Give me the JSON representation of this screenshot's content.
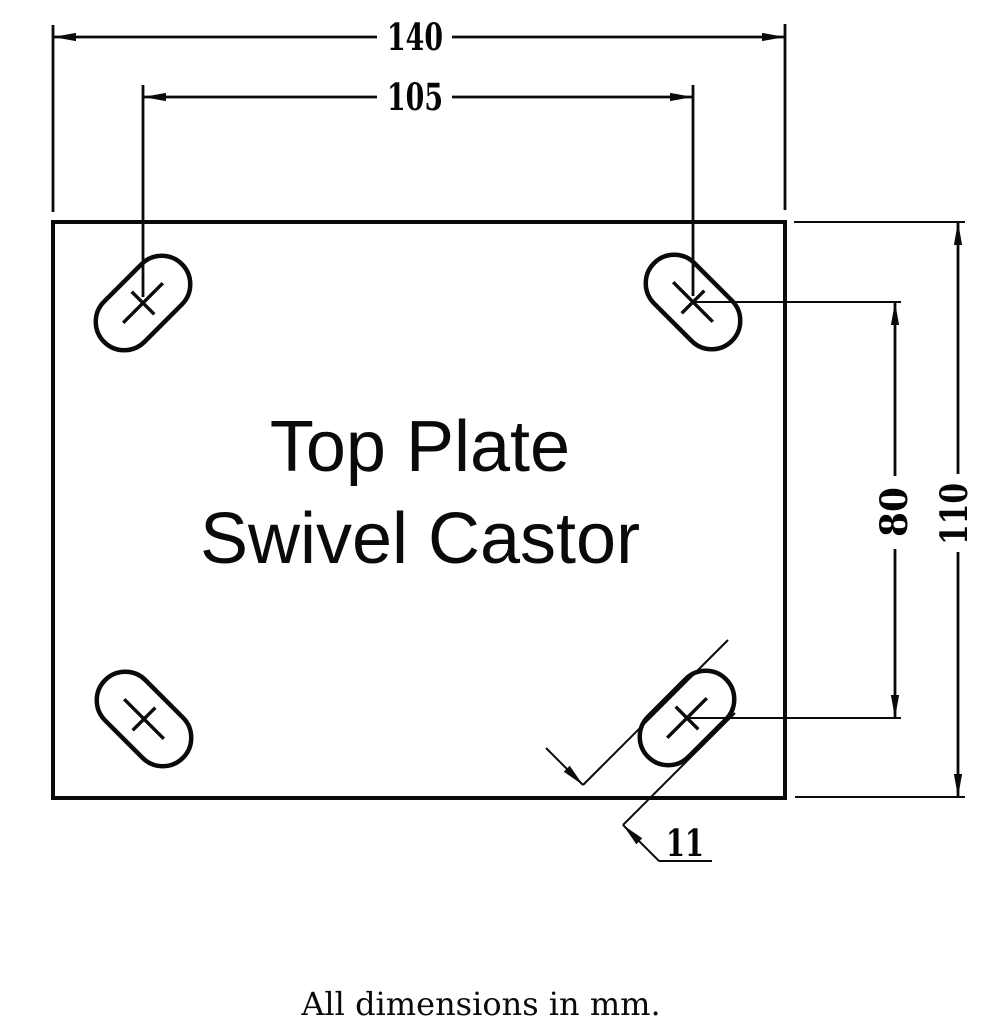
{
  "drawing_title": {
    "line1": "Top Plate",
    "line2": "Swivel Castor"
  },
  "dimensions": {
    "plate_width_mm": "140",
    "hole_spacing_width_mm": "105",
    "plate_height_mm": "110",
    "hole_spacing_height_mm": "80",
    "slot_width_mm": "11"
  },
  "footnote": "All dimensions in mm.",
  "units": "mm",
  "colors": {
    "line": "#0a0a0a",
    "background": "#ffffff"
  }
}
